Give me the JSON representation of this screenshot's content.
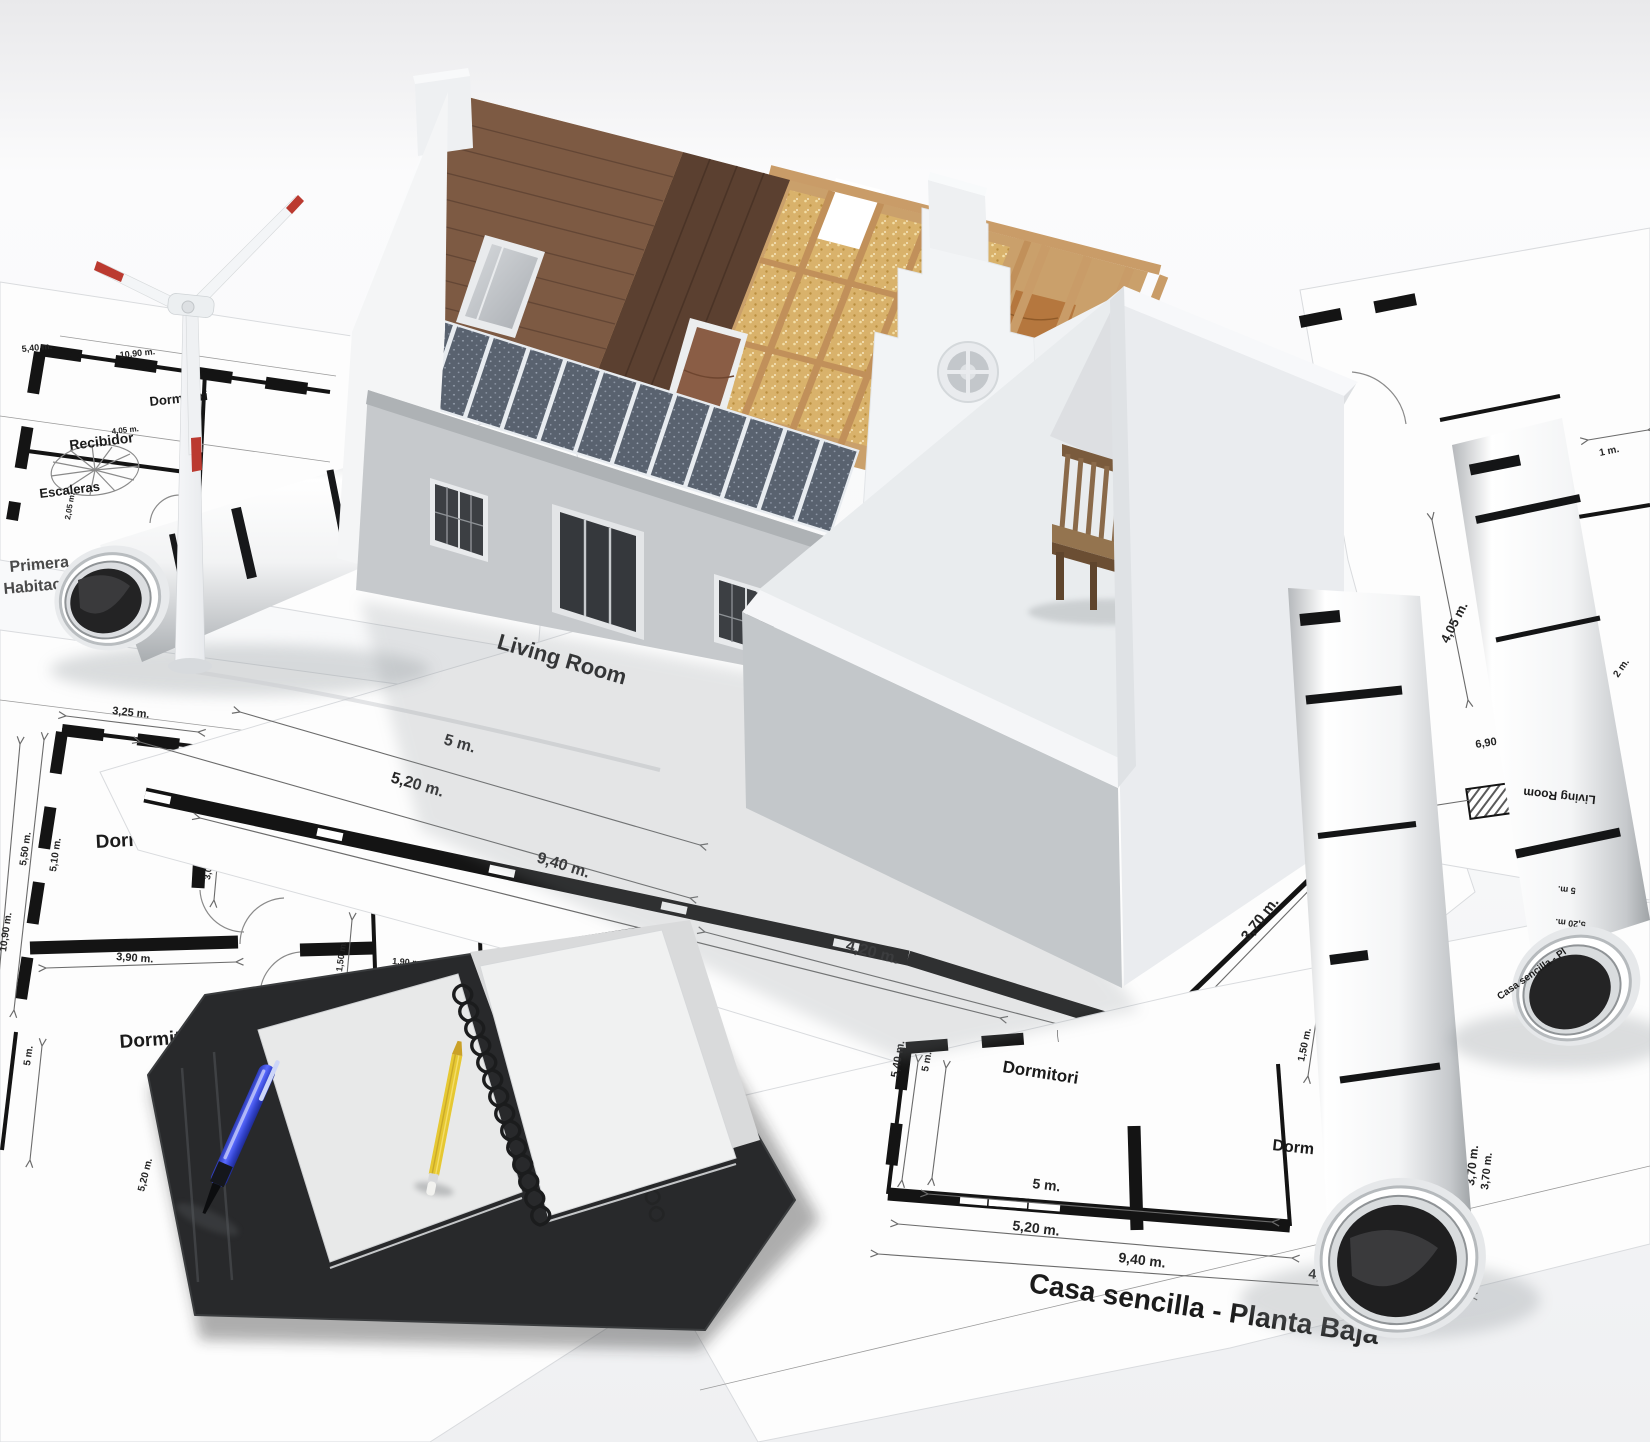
{
  "colors": {
    "paper": "#fdfdfd",
    "ink": "#1b1b1b",
    "dim_line": "#6b6b6b",
    "wall_light": "#f4f5f7",
    "wall_shade": "#c6c9cc",
    "roof_tile": "#7d5a43",
    "roof_wood": "#5b4030",
    "timber": "#c89a66",
    "insulation": "#d9b26b",
    "solar_panel": "#59626f",
    "solar_frame": "#e8ecf0",
    "pen_blue": "#4050d8",
    "pencil_yellow": "#e6c832",
    "bench_wood": "#8a6a4a",
    "folder_black": "#28292b",
    "turbine_red": "#bb3a30"
  },
  "plan_top_left": {
    "rooms": {
      "recibidor": "Recibidor",
      "escaleras": "Escaleras",
      "dormitorio": "Dormitori"
    },
    "dims": {
      "a": "5,40 m.",
      "b": "10,90 m.",
      "c": "4,05 m.",
      "d": "2,05 m."
    },
    "corner": {
      "line1": "Primera",
      "line2": "Habitacio"
    }
  },
  "plan_left": {
    "rooms": {
      "dormitorio2": "Dormitorio 2",
      "recibidor": "Recibidor",
      "bano": "Baño",
      "dormitorio3": "Dormitorio 3"
    },
    "dims": {
      "top": "3,25 m.",
      "v1": "2,05 m.",
      "v2": "3,05 m.",
      "v3": "2,05 m.",
      "v4": "1,50 m.",
      "v5": "1,50 m.",
      "l1": "5,50 m.",
      "l2": "5,10 m.",
      "l3": "10,90 m.",
      "l4": "5 m.",
      "l5": "5,20 m.",
      "h1": "3,90 m.",
      "h2": "1,90 m.",
      "h3": "2 m.",
      "h4": "4,35 m."
    }
  },
  "plan_center": {
    "room": "Living Room",
    "dims": {
      "d1": "5 m.",
      "d2": "5,20 m.",
      "d3": "9,40 m.",
      "d4": "4,20 m.",
      "d5": "3,70 m."
    }
  },
  "plan_bottom_right": {
    "title": "Casa sencilla - Planta Baja",
    "rooms": {
      "r1": "Dormitori",
      "r2": "Dorm"
    },
    "dims": {
      "d1": "5 m.",
      "d2": "5,20 m.",
      "d3": "9,40 m.",
      "d4": "4,20 m.",
      "v1": "5,40 m.",
      "v2": "5 m.",
      "v3": "1,50 m.",
      "v4": "3,70 m."
    }
  },
  "plan_right": {
    "rooms": {
      "recibidor": "Recibidor"
    },
    "dims": {
      "d1": "1 m.",
      "d2": "4,05 m.",
      "d3": "6,90 m.",
      "d4": "2 m."
    }
  },
  "rolls": {
    "living": "Living Room",
    "d5": "5 m.",
    "d520": "5,20 m.",
    "title": "Casa sencilla - Pl",
    "d370": "3,70 m."
  }
}
